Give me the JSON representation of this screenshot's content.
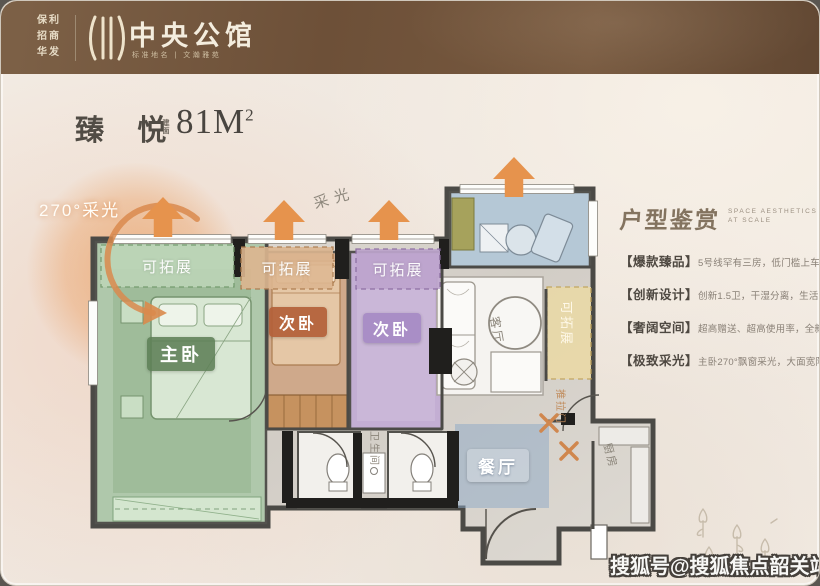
{
  "header": {
    "brands": [
      "保利",
      "招商",
      "华发"
    ],
    "project_name": "中央公馆",
    "subtitle": "标准地名 | 文瀚雅苑"
  },
  "unit": {
    "name": "臻 悦",
    "area_label_top": "建",
    "area_label_bottom": "面",
    "area_value": "81M",
    "area_sup": "2"
  },
  "plan": {
    "lighting_270_label": "270°采光",
    "lighting_label": "采光",
    "expandable_label": "可拓展",
    "master_label": "主卧",
    "bedroom2_label": "次卧",
    "bedroom3_label": "次卧",
    "dining_label": "餐厅",
    "living_label": "客厅",
    "kitchen_label": "厨房",
    "bathroom_label": "卫生间",
    "sliding_door_label": "推拉门"
  },
  "panel": {
    "title": "户型鉴赏",
    "title_en1": "SPACE AESTHETICS",
    "title_en2": "AT SCALE",
    "bullets": [
      {
        "tag": "【爆款臻品】",
        "desc": "5号线罕有三房，低门槛上车中心区"
      },
      {
        "tag": "【创新设计】",
        "desc": "创新1.5卫，干湿分离，生活从容有度"
      },
      {
        "tag": "【奢阔空间】",
        "desc": "超高赠送、超高使用率，全新迭代产品"
      },
      {
        "tag": "【极致采光】",
        "desc": "主卧270°飘窗采光，大面宽阳光相伴"
      }
    ]
  },
  "watermark": "搜狐号@搜狐焦点韶关站",
  "colors": {
    "header_brown": "#6e5239",
    "accent_orange": "#e6934d",
    "master_green": "#afc8ab",
    "bedroom_tan": "#cfa98b",
    "bedroom_purple": "#c3aed3",
    "balcony_blue": "#b5c8d6",
    "wall_dark": "#4b4a46"
  }
}
